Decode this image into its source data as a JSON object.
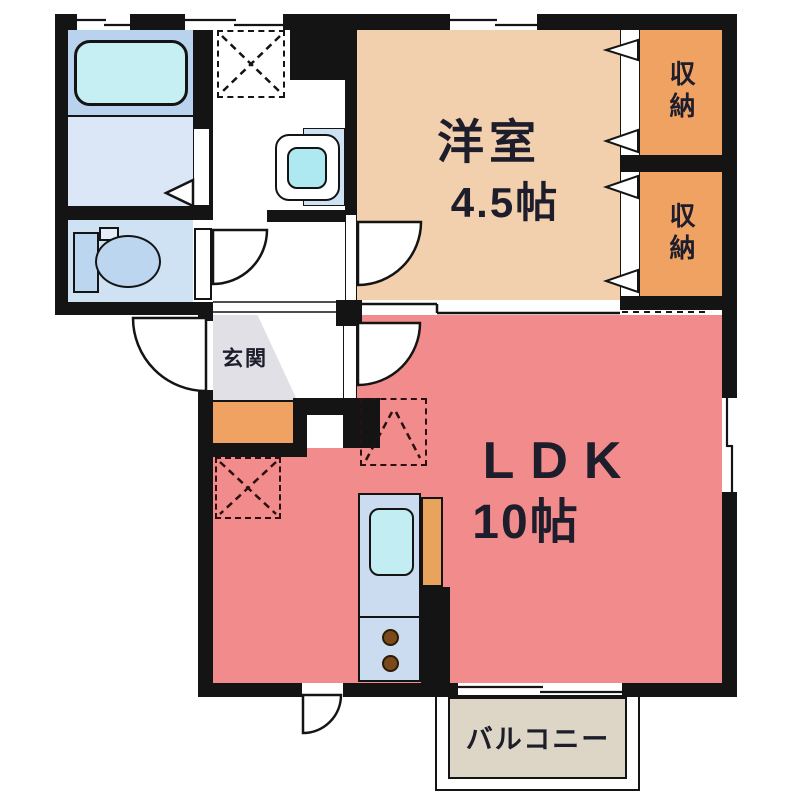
{
  "plan": {
    "type": "apartment-floor-plan",
    "rooms": {
      "western_room": {
        "label": "洋室",
        "size": "4.5帖",
        "fill": "#f2cfad"
      },
      "ldk": {
        "label": "LDK",
        "size": "10帖",
        "fill": "#f28b8b"
      },
      "storage_top": {
        "label": "収納",
        "fill": "#f0a263"
      },
      "storage_bottom": {
        "label": "収納",
        "fill": "#f0a263"
      },
      "entrance": {
        "label": "玄関",
        "fill": "#e0e0e6"
      },
      "balcony": {
        "label": "バルコニー",
        "fill": "#ddd6c6"
      }
    },
    "colors": {
      "wall": "#141414",
      "bath_tub_zone": "#b9d3ef",
      "bath_floor": "#dbe7f7",
      "toilet_room": "#cfe2f4",
      "tub": "#c6eff3",
      "sink": "#c2eef3",
      "basin_bowl": "#aee8f0",
      "kitchen_counter": "#ccdcf0",
      "counter_side": "#e8a45c",
      "burner": "#7a4a1d",
      "shoe_cabinet": "#f0a263"
    }
  }
}
